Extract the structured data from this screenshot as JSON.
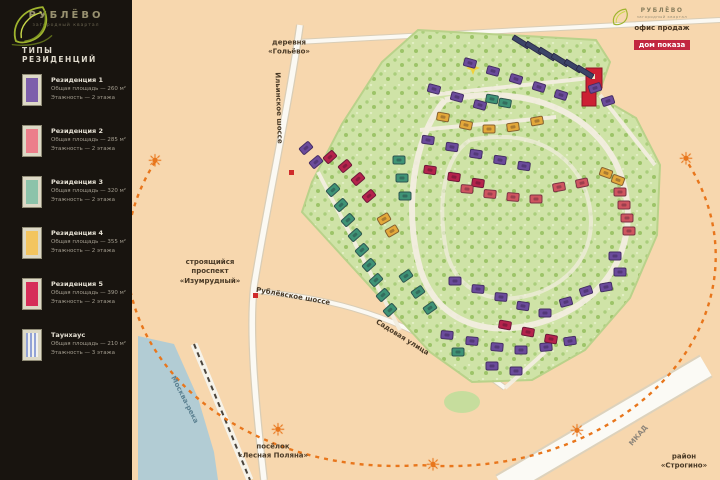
{
  "brand": {
    "name": "РУБЛЁВО",
    "tagline": "загородный квартал"
  },
  "legend": {
    "title": "ТИПЫ РЕЗИДЕНЦИЙ",
    "items": [
      {
        "name": "Резиденция 1",
        "area": "Общая площадь — 260 м²",
        "floors": "Этажность — 2 этажа",
        "color": "#7d5fab",
        "striped": false
      },
      {
        "name": "Резиденция 2",
        "area": "Общая площадь — 285 м²",
        "floors": "Этажность — 2 этажа",
        "color": "#ec7f8b",
        "striped": false
      },
      {
        "name": "Резиденция 3",
        "area": "Общая площадь — 320 м²",
        "floors": "Этажность — 2 этажа",
        "color": "#8cc3aa",
        "striped": false
      },
      {
        "name": "Резиденция 4",
        "area": "Общая площадь — 355 м²",
        "floors": "Этажность — 2 этажа",
        "color": "#f3c55f",
        "striped": false
      },
      {
        "name": "Резиденция 5",
        "area": "Общая площадь — 390 м²",
        "floors": "Этажность — 2 этажа",
        "color": "#d62e59",
        "striped": false
      },
      {
        "name": "Таунхаус",
        "area": "Общая площадь — 210 м²",
        "floors": "Этажность — 3 этажа",
        "color": "#93a3d6",
        "striped": true
      }
    ]
  },
  "office": {
    "brand": "РУБЛЁВО",
    "tagline": "загородный квартал",
    "line1": "офис продаж",
    "line2": "дом показа"
  },
  "map": {
    "colors": {
      "beige": "#f7d7ae",
      "site": "#cfe3a7",
      "water": "#b2ccd4",
      "orange": "#e8761c",
      "purple": "#6b4b9b",
      "crimson": "#b5234c",
      "salmon": "#cf5560",
      "teal": "#3f9376",
      "yellow": "#e3a83a",
      "navy": "#3c4468",
      "office_red": "#cc2133"
    },
    "sun_icon": "☀",
    "suns": [
      [
        155,
        162
      ],
      [
        686,
        160
      ],
      [
        278,
        431
      ],
      [
        433,
        466
      ],
      [
        577,
        432
      ]
    ],
    "labels": [
      {
        "id": "village-north",
        "lines": [
          "деревня",
          "«Гольёво»"
        ],
        "x": 289,
        "y": 48,
        "rot": 0
      },
      {
        "id": "road-vertical",
        "lines": [
          "Ильинское шоссе"
        ],
        "x": 278,
        "y": 108,
        "rot": 88
      },
      {
        "id": "prospekt-construction",
        "lines": [
          "строящийся",
          "проспект",
          "«Изумрудный»"
        ],
        "x": 210,
        "y": 272,
        "rot": 0
      },
      {
        "id": "rublevskoe-shosse",
        "lines": [
          "Рублёвское шоссе"
        ],
        "x": 293,
        "y": 297,
        "rot": 10
      },
      {
        "id": "sadovaya-street",
        "lines": [
          "Садовая улица"
        ],
        "x": 402,
        "y": 338,
        "rot": 32
      },
      {
        "id": "moskva-river",
        "lines": [
          "Москва-река"
        ],
        "x": 184,
        "y": 400,
        "rot": 63,
        "c": "#5d8292"
      },
      {
        "id": "village-south",
        "lines": [
          "посёлок",
          "«Лесная Поляна»"
        ],
        "x": 273,
        "y": 452,
        "rot": 0
      },
      {
        "id": "district-strogino",
        "lines": [
          "район",
          "«Строгино»"
        ],
        "x": 684,
        "y": 462,
        "rot": 0
      },
      {
        "id": "mkad",
        "lines": [
          "МКАД"
        ],
        "x": 639,
        "y": 436,
        "rot": -50,
        "c": "#8d857a"
      }
    ],
    "houses": [
      [
        521,
        42,
        32,
        "n"
      ],
      [
        534,
        48,
        32,
        "n"
      ],
      [
        547,
        54,
        32,
        "n"
      ],
      [
        560,
        60,
        32,
        "n"
      ],
      [
        573,
        66,
        32,
        "n"
      ],
      [
        585,
        72,
        32,
        "n"
      ],
      [
        470,
        63,
        15,
        "p"
      ],
      [
        493,
        71,
        15,
        "p"
      ],
      [
        516,
        79,
        17,
        "p"
      ],
      [
        539,
        87,
        17,
        "p"
      ],
      [
        561,
        95,
        17,
        "p"
      ],
      [
        434,
        89,
        15,
        "p"
      ],
      [
        457,
        97,
        15,
        "p"
      ],
      [
        480,
        105,
        15,
        "p"
      ],
      [
        595,
        88,
        -18,
        "p"
      ],
      [
        608,
        101,
        -18,
        "p"
      ],
      [
        428,
        140,
        8,
        "p"
      ],
      [
        452,
        147,
        8,
        "p"
      ],
      [
        476,
        154,
        8,
        "p"
      ],
      [
        500,
        160,
        8,
        "p"
      ],
      [
        524,
        166,
        8,
        "p"
      ],
      [
        455,
        281,
        0,
        "p"
      ],
      [
        478,
        289,
        5,
        "p"
      ],
      [
        501,
        297,
        5,
        "p"
      ],
      [
        523,
        306,
        8,
        "p"
      ],
      [
        545,
        313,
        0,
        "p"
      ],
      [
        566,
        302,
        -15,
        "p"
      ],
      [
        586,
        291,
        -18,
        "p"
      ],
      [
        615,
        256,
        0,
        "p"
      ],
      [
        620,
        272,
        0,
        "p"
      ],
      [
        606,
        287,
        -10,
        "p"
      ],
      [
        447,
        335,
        5,
        "p"
      ],
      [
        472,
        341,
        5,
        "p"
      ],
      [
        497,
        347,
        5,
        "p"
      ],
      [
        521,
        350,
        0,
        "p"
      ],
      [
        546,
        347,
        -5,
        "p"
      ],
      [
        570,
        341,
        -8,
        "p"
      ],
      [
        492,
        366,
        0,
        "p"
      ],
      [
        516,
        371,
        0,
        "p"
      ],
      [
        306,
        148,
        -40,
        "p"
      ],
      [
        316,
        162,
        -40,
        "p"
      ],
      [
        333,
        190,
        -42,
        "t"
      ],
      [
        341,
        205,
        -42,
        "t"
      ],
      [
        348,
        220,
        -42,
        "t"
      ],
      [
        355,
        235,
        -42,
        "t"
      ],
      [
        362,
        250,
        -42,
        "t"
      ],
      [
        369,
        265,
        -42,
        "t"
      ],
      [
        376,
        280,
        -42,
        "t"
      ],
      [
        383,
        295,
        -42,
        "t"
      ],
      [
        390,
        310,
        -42,
        "t"
      ],
      [
        399,
        160,
        0,
        "t"
      ],
      [
        402,
        178,
        0,
        "t"
      ],
      [
        405,
        196,
        0,
        "t"
      ],
      [
        406,
        276,
        -35,
        "t"
      ],
      [
        418,
        292,
        -35,
        "t"
      ],
      [
        430,
        308,
        -35,
        "t"
      ],
      [
        458,
        352,
        0,
        "t"
      ],
      [
        492,
        99,
        10,
        "t"
      ],
      [
        505,
        103,
        10,
        "t"
      ],
      [
        443,
        117,
        10,
        "y"
      ],
      [
        466,
        125,
        12,
        "y"
      ],
      [
        489,
        129,
        0,
        "y"
      ],
      [
        513,
        127,
        -8,
        "y"
      ],
      [
        537,
        121,
        -10,
        "y"
      ],
      [
        384,
        219,
        -30,
        "y"
      ],
      [
        392,
        231,
        -30,
        "y"
      ],
      [
        606,
        173,
        20,
        "y"
      ],
      [
        618,
        180,
        20,
        "y"
      ],
      [
        330,
        157,
        -42,
        "r"
      ],
      [
        345,
        166,
        -40,
        "r"
      ],
      [
        358,
        179,
        -40,
        "r"
      ],
      [
        369,
        196,
        -40,
        "r"
      ],
      [
        430,
        170,
        8,
        "r"
      ],
      [
        454,
        177,
        8,
        "r"
      ],
      [
        478,
        183,
        8,
        "r"
      ],
      [
        505,
        325,
        10,
        "r"
      ],
      [
        528,
        332,
        10,
        "r"
      ],
      [
        551,
        339,
        10,
        "r"
      ],
      [
        467,
        189,
        5,
        "s"
      ],
      [
        490,
        194,
        5,
        "s"
      ],
      [
        513,
        197,
        5,
        "s"
      ],
      [
        536,
        199,
        0,
        "s"
      ],
      [
        559,
        187,
        -10,
        "s"
      ],
      [
        582,
        183,
        -12,
        "s"
      ],
      [
        620,
        192,
        0,
        "s"
      ],
      [
        624,
        205,
        0,
        "s"
      ],
      [
        627,
        218,
        0,
        "s"
      ],
      [
        629,
        231,
        0,
        "s"
      ]
    ]
  }
}
